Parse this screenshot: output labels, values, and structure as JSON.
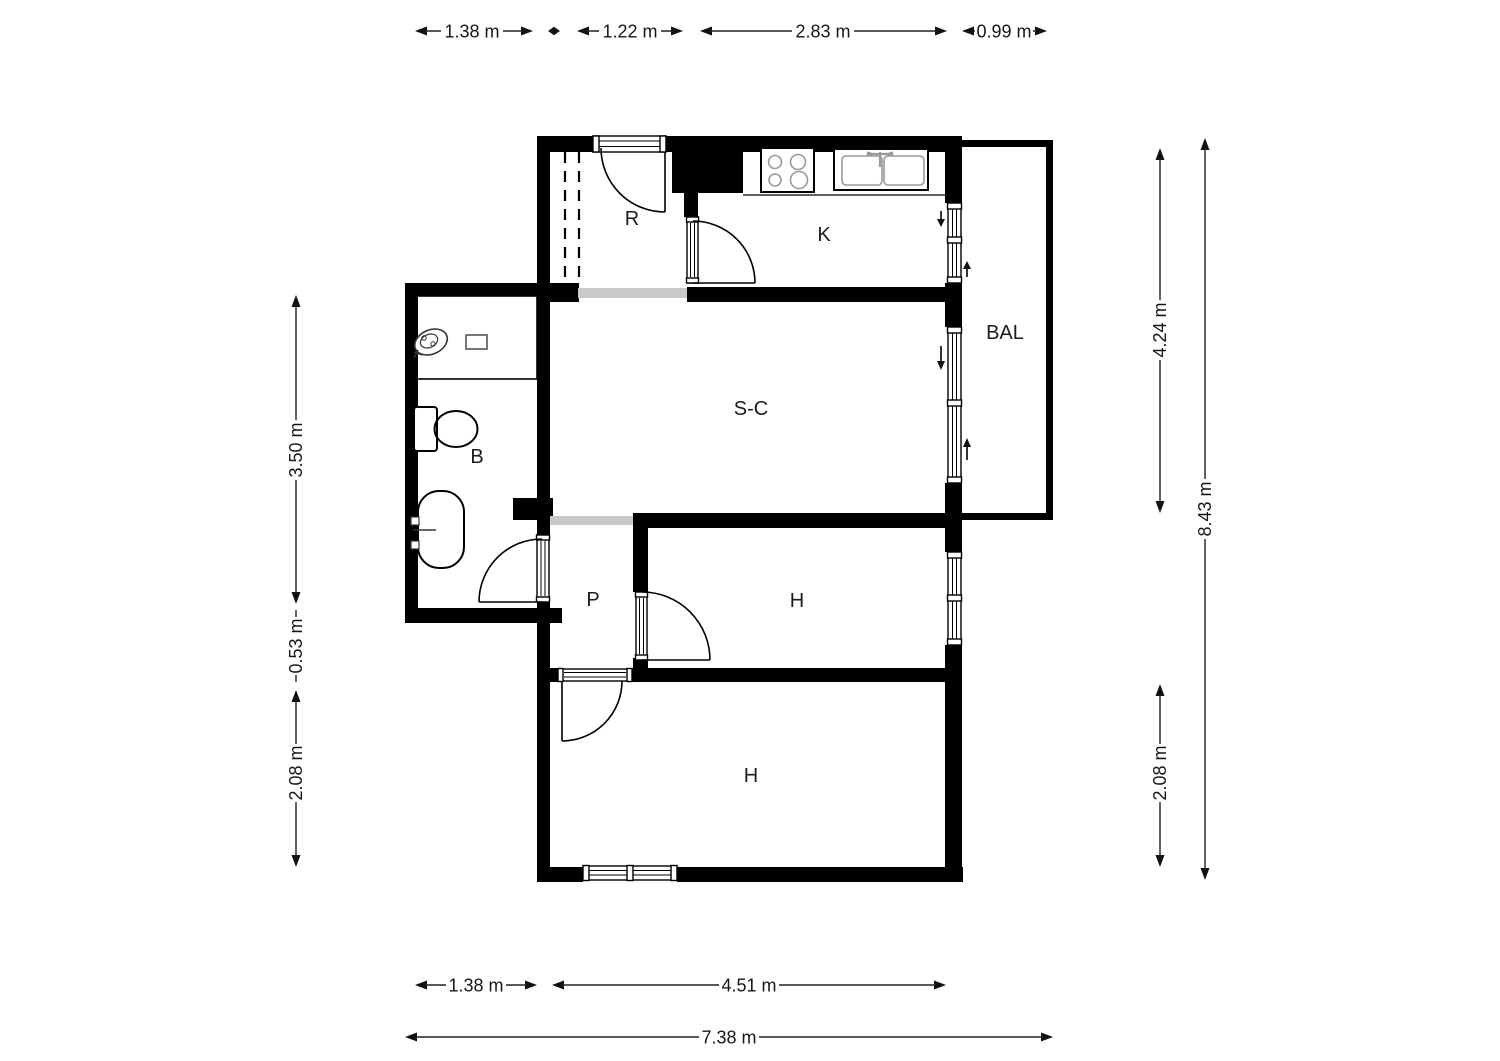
{
  "plan": {
    "rooms": {
      "r": "R",
      "k": "K",
      "bal": "BAL",
      "sc": "S-C",
      "b": "B",
      "p": "P",
      "h1": "H",
      "h2": "H"
    },
    "dims": {
      "top": [
        "1.38 m",
        "1.22 m",
        "2.83 m",
        "0.99 m"
      ],
      "left": [
        "3.50 m",
        "0.53 m",
        "2.08 m"
      ],
      "right": [
        "4.24 m",
        "8.43 m",
        "2.08 m"
      ],
      "bottom": [
        "1.38 m",
        "4.51 m",
        "7.38 m"
      ]
    }
  }
}
